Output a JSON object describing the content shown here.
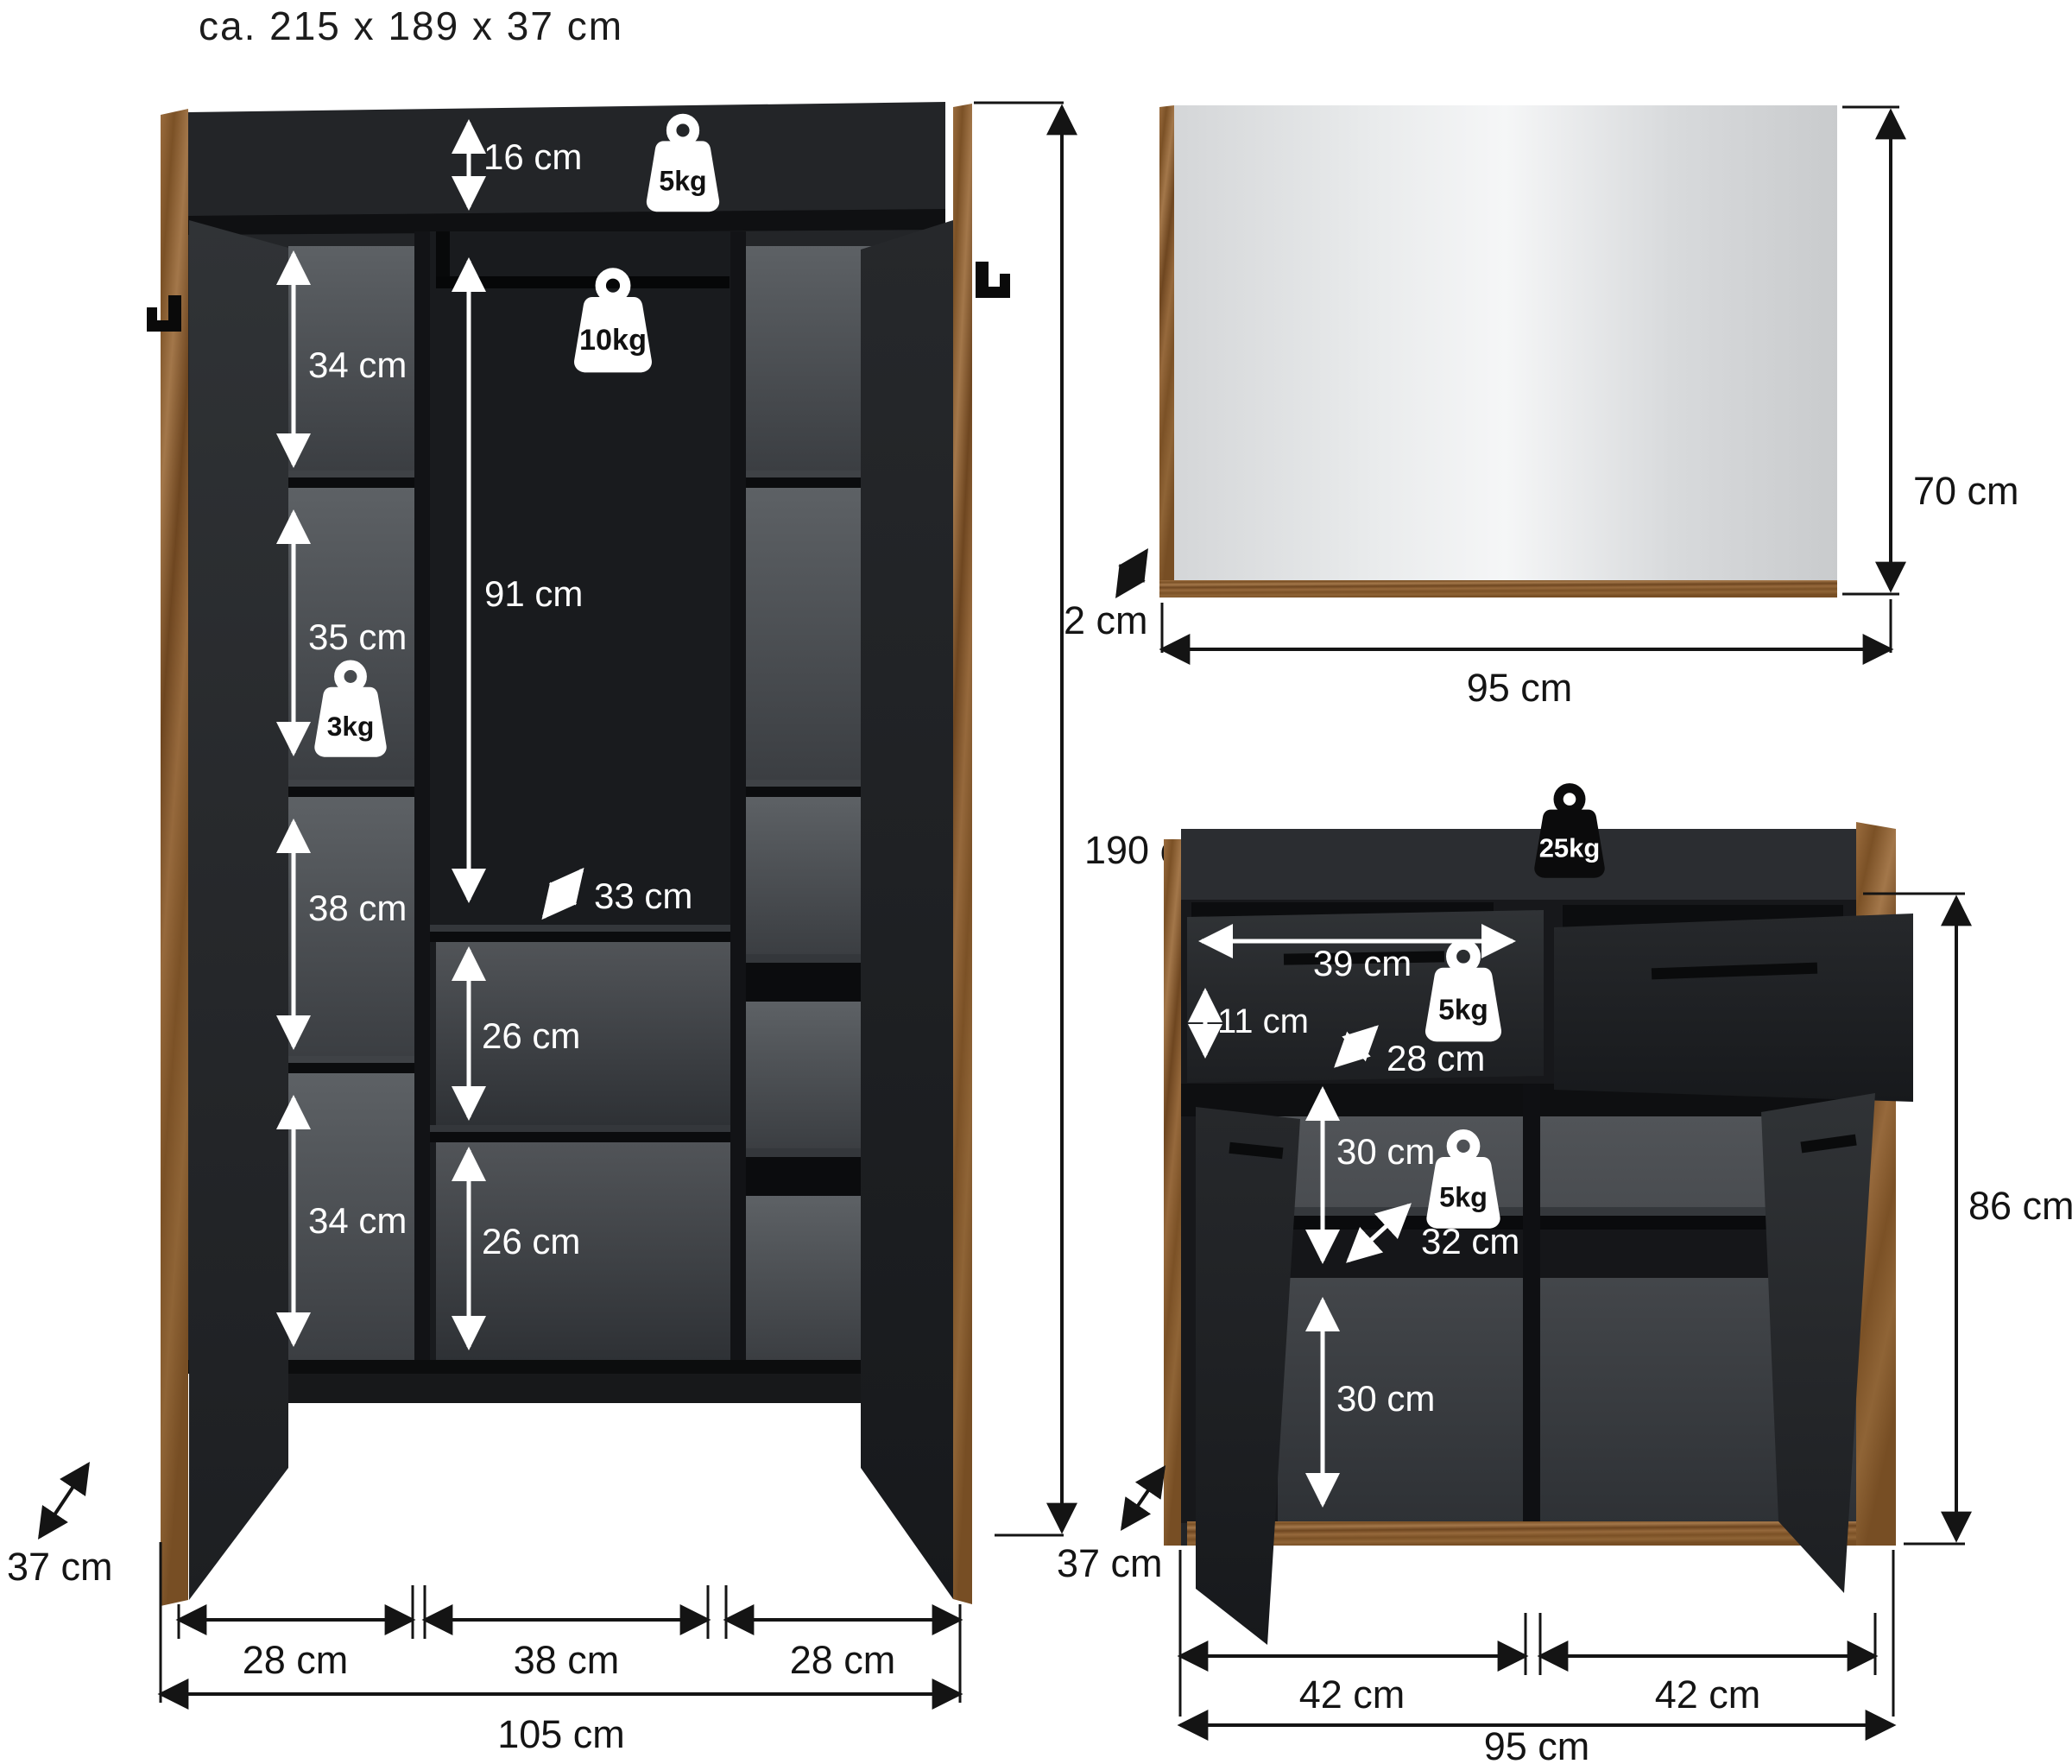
{
  "title": "ca. 215 x 189 x 37  cm",
  "colors": {
    "background": "#ffffff",
    "cabinet_body": "#232528",
    "shelf_edge": "#0b0c0e",
    "back_panel_light": "#5d6165",
    "back_panel_dark": "#3b3e42",
    "wood": "#96693c",
    "mirror_surface": "#eceeef",
    "dimension_line": "#141414",
    "label_on_dark": "#ffffff",
    "weight_badge_light": "#ffffff",
    "weight_badge_dark": "#0b0b0c"
  },
  "wardrobe": {
    "dims": {
      "top_clearance": "16 cm",
      "left_shelf_1": "34 cm",
      "left_shelf_2": "35 cm",
      "left_shelf_3": "38 cm",
      "left_shelf_4": "34 cm",
      "hanging_height": "91 cm",
      "hanging_depth": "33 cm",
      "mid_shelf_1": "26 cm",
      "mid_shelf_2": "26 cm",
      "depth": "37 cm",
      "bottom_left": "28 cm",
      "bottom_mid": "38 cm",
      "bottom_right": "28 cm",
      "total_width": "105 cm",
      "total_height": "190 cm"
    },
    "weights": {
      "top": "5kg",
      "rod": "10kg",
      "shelf": "3kg"
    }
  },
  "mirror": {
    "dims": {
      "height": "70 cm",
      "width": "95 cm",
      "depth": "2 cm"
    }
  },
  "sideboard": {
    "dims": {
      "drawer_width": "39 cm",
      "drawer_height": "11 cm",
      "drawer_depth": "28 cm",
      "compartment_1": "30 cm",
      "compartment_depth": "32 cm",
      "compartment_2": "30 cm",
      "height": "86 cm",
      "depth": "37 cm",
      "bottom_left": "42 cm",
      "bottom_right": "42 cm",
      "total_width": "95 cm"
    },
    "weights": {
      "top": "25kg",
      "drawer": "5kg",
      "shelf": "5kg"
    }
  }
}
